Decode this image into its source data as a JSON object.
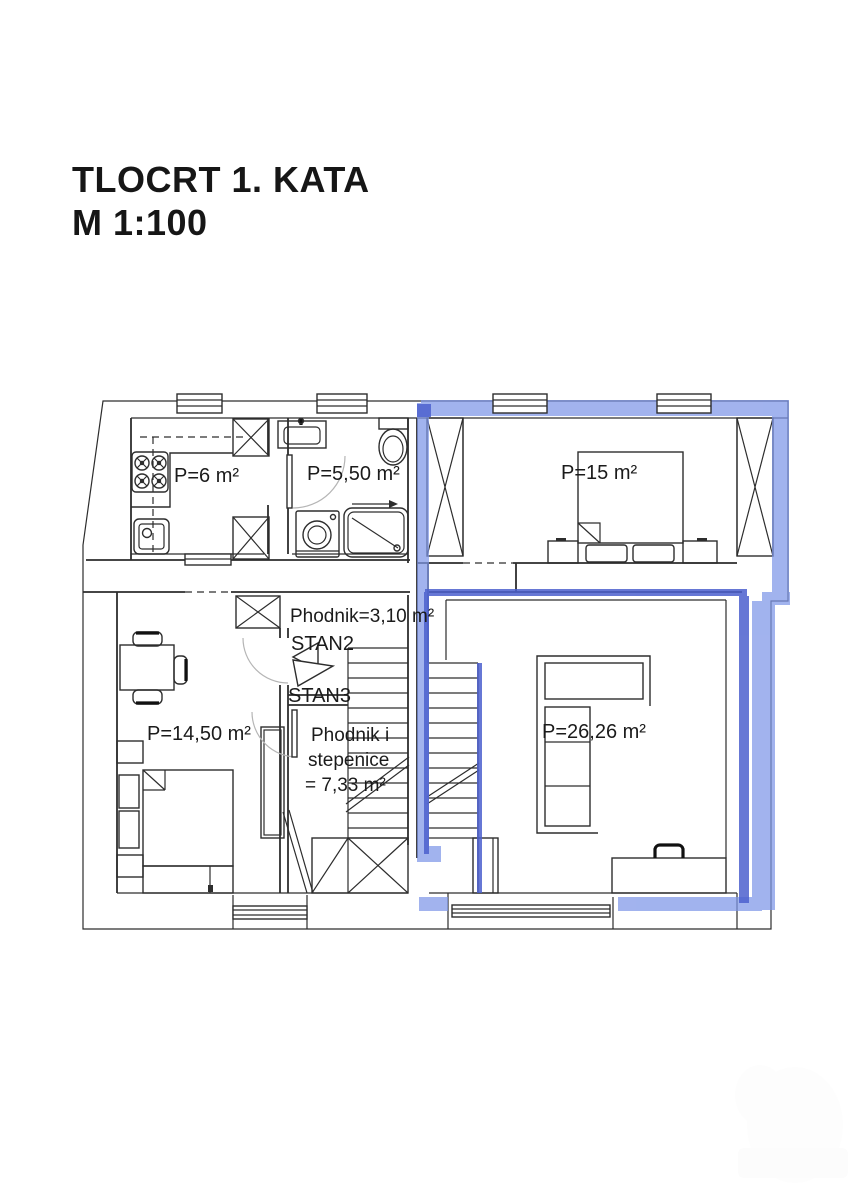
{
  "title": {
    "line1": "TLOCRT 1. KATA",
    "line2": "M 1:100"
  },
  "plan": {
    "rooms": {
      "kitchen": {
        "label": "P=6 m²"
      },
      "bathroom": {
        "label": "P=5,50 m²"
      },
      "bedroom": {
        "label": "P=15 m²"
      },
      "hallway": {
        "label": "Phodnik=3,10 m²"
      },
      "stan2": {
        "label": "STAN2"
      },
      "stan3": {
        "label": "STAN3"
      },
      "room_south": {
        "label": "P=14,50 m²"
      },
      "hall_stairs": {
        "line1": "Phodnik i",
        "line2": "stepenice",
        "line3": "= 7,33 m²"
      },
      "living": {
        "label": "P=26,26 m²"
      }
    },
    "colors": {
      "highlight_light": "#7E96E8",
      "highlight_dark": "#4C60CE",
      "wall_line": "#2d2d2d"
    }
  }
}
